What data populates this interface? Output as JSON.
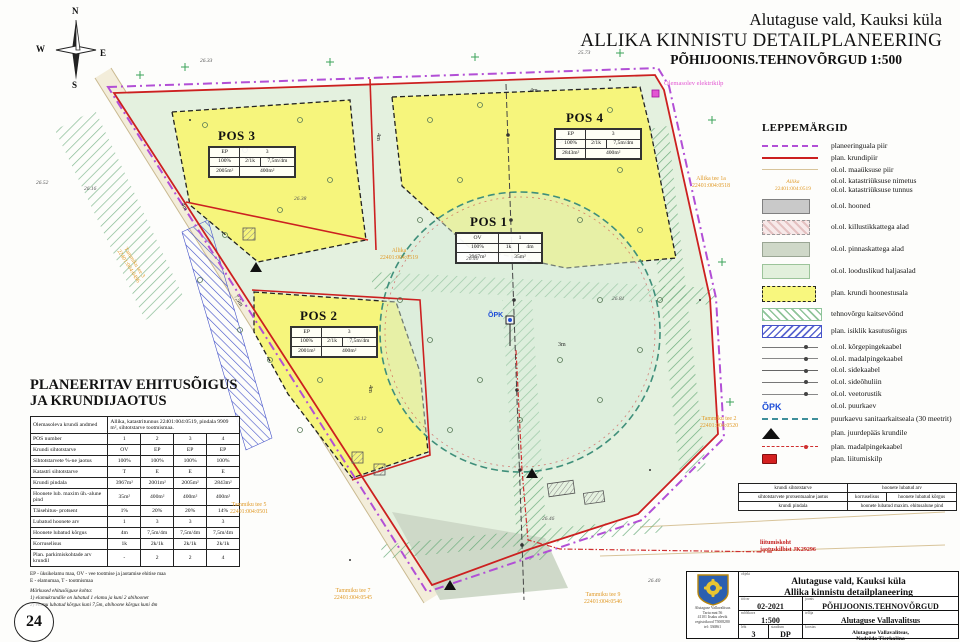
{
  "title": {
    "line1": "Alutaguse vald, Kauksi küla",
    "line2": "ALLIKA KINNISTU DETAILPLANEERING",
    "line3": "PÕHIJOONIS.TEHNOVÕRGUD 1:500"
  },
  "compass": {
    "n": "N",
    "e": "E",
    "s": "S",
    "w": "W"
  },
  "legend": {
    "title": "LEPPEMÄRGID",
    "sample_name": "Allika",
    "sample_code": "22401:004:0519",
    "items": [
      {
        "label": "planeeringuala piir"
      },
      {
        "label": "plan. krundipiir"
      },
      {
        "label": "ol.ol. maaüksuse piir"
      },
      {
        "label": "ol.ol. katastriüksuse nimetus",
        "label2": "ol.ol. katastriüksuse tunnus"
      },
      {
        "label": "ol.ol. hooned"
      },
      {
        "label": "ol.ol. killustikkattega alad"
      },
      {
        "label": "ol.ol. pinnaskattega alad"
      },
      {
        "label": "ol.ol. looduslikud haljasalad"
      },
      {
        "label": "plan. krundi hoonestusala"
      },
      {
        "label": "tehnovõrgu kaitsevöönd"
      },
      {
        "label": "plan. isiklik kasutusõigus"
      },
      {
        "label": "ol.ol. kõrgepingekaabel"
      },
      {
        "label": "ol.ol. madalpingekaabel"
      },
      {
        "label": "ol.ol. sidekaabel"
      },
      {
        "label": "ol.ol. sideõhuliin"
      },
      {
        "label": "ol.ol. veetorustik"
      },
      {
        "label": "ol.ol. puurkaev",
        "symbol": "ÕPK"
      },
      {
        "label": "puurkaevu sanitaarkaitseala (30 meetrit)"
      },
      {
        "label": "plan. juurdepääs krundile"
      },
      {
        "label": "plan. madalpingekaabel"
      },
      {
        "label": "plan. liitumiskilp"
      }
    ]
  },
  "pos1": {
    "title": "POS 1",
    "use": "OV",
    "count": "1",
    "pct": "100%",
    "floors": "1k",
    "height": "4m",
    "area": "3967m²",
    "build": "35m²"
  },
  "pos2": {
    "title": "POS 2",
    "use": "EP",
    "count": "3",
    "pct": "100%",
    "floors": "2/1k",
    "height": "7,5m/4m",
    "area": "2001m²",
    "build": "400m²"
  },
  "pos3": {
    "title": "POS 3",
    "use": "EP",
    "count": "3",
    "pct": "100%",
    "floors": "2/1k",
    "height": "7,5m/4m",
    "area": "2005m²",
    "build": "400m²"
  },
  "pos4": {
    "title": "POS 4",
    "use": "EP",
    "count": "3",
    "pct": "100%",
    "floors": "2/1k",
    "height": "7,5m/4m",
    "area": "2843m²",
    "build": "400m²"
  },
  "table": {
    "title1": "PLANEERITAV EHITUSÕIGUS",
    "title2": "JA KRUNDIJAOTUS",
    "header_label": "Olemasoleva krundi andmed",
    "header_value": "Allika, katastritunnus 22401:004:0519, pindala 9909 m², sihtotstarve tootmismaa.",
    "rows": [
      {
        "label": "POS number",
        "values": [
          "1",
          "2",
          "3",
          "4"
        ]
      },
      {
        "label": "Krundi sihtotstarve",
        "values": [
          "OV",
          "EP",
          "EP",
          "EP"
        ]
      },
      {
        "label": "Sihtotstarvete %-ne jaotus",
        "values": [
          "100%",
          "100%",
          "100%",
          "100%"
        ]
      },
      {
        "label": "Katastri sihtotstarve",
        "values": [
          "T",
          "E",
          "E",
          "E"
        ]
      },
      {
        "label": "Krundi pindala",
        "values": [
          "3967m²",
          "2001m²",
          "2005m²",
          "2843m²"
        ]
      },
      {
        "label": "Hoonete lub. maxim üh.-alune pind",
        "values": [
          "35m²",
          "400m²",
          "400m²",
          "400m²"
        ]
      },
      {
        "label": "Täisehitus- protsent",
        "values": [
          "1%",
          "20%",
          "20%",
          "14%"
        ]
      },
      {
        "label": "Lubatud hoonete arv",
        "values": [
          "1",
          "3",
          "3",
          "3"
        ]
      },
      {
        "label": "Hoonete lubatud kõrgus",
        "values": [
          "4m",
          "7,5m/4m",
          "7,5m/4m",
          "7,5m/4m"
        ]
      },
      {
        "label": "Korruselisus",
        "values": [
          "1k",
          "2k/1k",
          "2k/1k",
          "2k/1k"
        ]
      },
      {
        "label": "Plan. parkimiskohtade arv krundil",
        "values": [
          "-",
          "2",
          "2",
          "4"
        ]
      }
    ],
    "footnote1": "EP - üksikelamu maa, OV - vee tootmise ja jaotamise ehitise maa",
    "footnote2": "E - elamumaa, T - tootmismaa",
    "notes_title": "Märkused ehitusõiguse kohta:",
    "note1": "1) elamukrundile on lubatud 1 elamu ja kuni 2 abihoonet",
    "note2": "2) elamu lubatud kõrgus kuni 7,5m, abihoone kõrgus kuni 4m"
  },
  "pos_key": {
    "r1c1": "krundi sihtotstarve",
    "r1c2": "hoonete lubatud arv",
    "r2c1": "sihtotstarvete protsentuaalne jaotus",
    "r2c2": "korruselisus",
    "r2c3": "hoonete lubatud kõrgus",
    "r3c1": "krundi pindala",
    "r3c2": "hoonete lubatud maxim. ehitusalune pind"
  },
  "map": {
    "labels": {
      "allika_name": "Allika",
      "allika_code": "22401:004:0519",
      "elektrikilp": "Olemasolev elektrikilp",
      "liitumiskoht1": "liitumiskoht",
      "liitumiskoht2": "jaotuskilbist JK29296",
      "t3a": "Tammiku tee 3",
      "t3b": "22401:004:0496",
      "t5a": "Tammiku tee 5",
      "t5b": "22401:004:0501",
      "t7a": "Tammiku tee 7",
      "t7b": "22401:004:0545",
      "t9a": "Tammiku tee 9",
      "t9b": "22401:004:0546",
      "a1a": "Allika tee 1a",
      "a1b": "22401:004:0518",
      "t2a": "Tammiku tee 2",
      "t2b": "22401:004:0520",
      "opk": "ÕPK",
      "sheet": "24"
    },
    "dims": [
      "4m",
      "4m",
      "4m",
      "7,5m",
      "4m",
      "3m"
    ],
    "elev": [
      "26.52",
      "26.16",
      "26.38",
      "26.40",
      "25.73",
      "26.81",
      "26.12",
      "26.46",
      "26.40",
      "26.33"
    ]
  },
  "title_block": {
    "project1": "Alutaguse vald, Kauksi küla",
    "project2": "Allika kinnistu detailplaneering",
    "lbl_object": "objekt",
    "lbl_work": "töö nr",
    "work_no": "02-2021",
    "lbl_drawing": "joonis",
    "drawing": "PÕHIJOONIS.TEHNOVÕRGUD",
    "lbl_scale": "mõõtkava",
    "scale": "1:500",
    "lbl_client": "tellija",
    "client": "Alutaguse Vallavalitsus",
    "lbl_sheet": "leht",
    "sheet": "3",
    "lbl_stage": "staadium",
    "stage": "DP",
    "lbl_author": "koostas",
    "author1": "Alutaguse Vallavalitsus,",
    "author2": "Nadežda Tšerkašina",
    "org1": "Alutaguse Vallavalitsus",
    "org2": "Tartu mnt 56",
    "org3": "41101 Iisaku alevik",
    "org4": "registrikood 75008280",
    "org5": "tel: 336861"
  }
}
